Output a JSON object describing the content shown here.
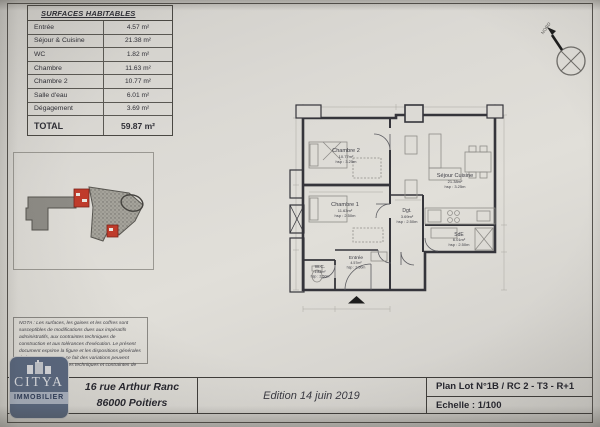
{
  "surfaces_table": {
    "title": "SURFACES HABITABLES",
    "rows": [
      {
        "label": "Entrée",
        "value": "4.57 m²"
      },
      {
        "label": "Séjour & Cuisine",
        "value": "21.38 m²"
      },
      {
        "label": "WC",
        "value": "1.82 m²"
      },
      {
        "label": "Chambre",
        "value": "11.63 m²"
      },
      {
        "label": "Chambre 2",
        "value": "10.77 m²"
      },
      {
        "label": "Salle d'eau",
        "value": "6.01 m²"
      },
      {
        "label": "Dégagement",
        "value": "3.69 m²"
      }
    ],
    "total_label": "TOTAL",
    "total_value": "59.87 m²"
  },
  "floorplan": {
    "rooms": [
      {
        "name": "Chambre 2",
        "area": "10.77m²",
        "height": "hsp : 3.25m"
      },
      {
        "name": "Séjour Cuisine",
        "area": "21.38m²",
        "height": "hsp : 3.25m"
      },
      {
        "name": "Chambre 1",
        "area": "11.63m²",
        "height": "hsp : 2.50m"
      },
      {
        "name": "Dgt.",
        "area": "3.69m²",
        "height": "hsp : 2.50m"
      },
      {
        "name": "SdE",
        "area": "6.01m²",
        "height": "hsp : 2.50m"
      },
      {
        "name": "W.C.",
        "area": "1.82m²",
        "height": "hsp : 2.50m"
      },
      {
        "name": "Entrée",
        "area": "4.57m²",
        "height": "hsp : 2.50m"
      }
    ],
    "north_label": "NORD"
  },
  "nota": {
    "text": "NOTA : Les surfaces, les gaines et les coffres sont susceptibles de modifications dues aux impératifs administratifs, aux contraintes techniques de construction et aux tolérances d'exécution. Le présent document exprime la figure et les dispositions générales de l'appartement. De ce fait des variations peuvent intervenir en fonction des techniques et contraintes de réalisation."
  },
  "footer": {
    "logo": {
      "name": "CITYA",
      "subtitle": "IMMOBILIER"
    },
    "address_line1": "16 rue Arthur Ranc",
    "address_line2": "86000 Poitiers",
    "edition": "Edition 14 juin 2019",
    "plan_ref": "Plan Lot N°1B / RC 2 - T3 - R+1",
    "scale": "Echelle : 1/100"
  },
  "colors": {
    "paper": "#dcdad5",
    "line": "#3f3d3a",
    "logo_blue": "#5a6880",
    "highlight_red": "#bf3b2b"
  }
}
